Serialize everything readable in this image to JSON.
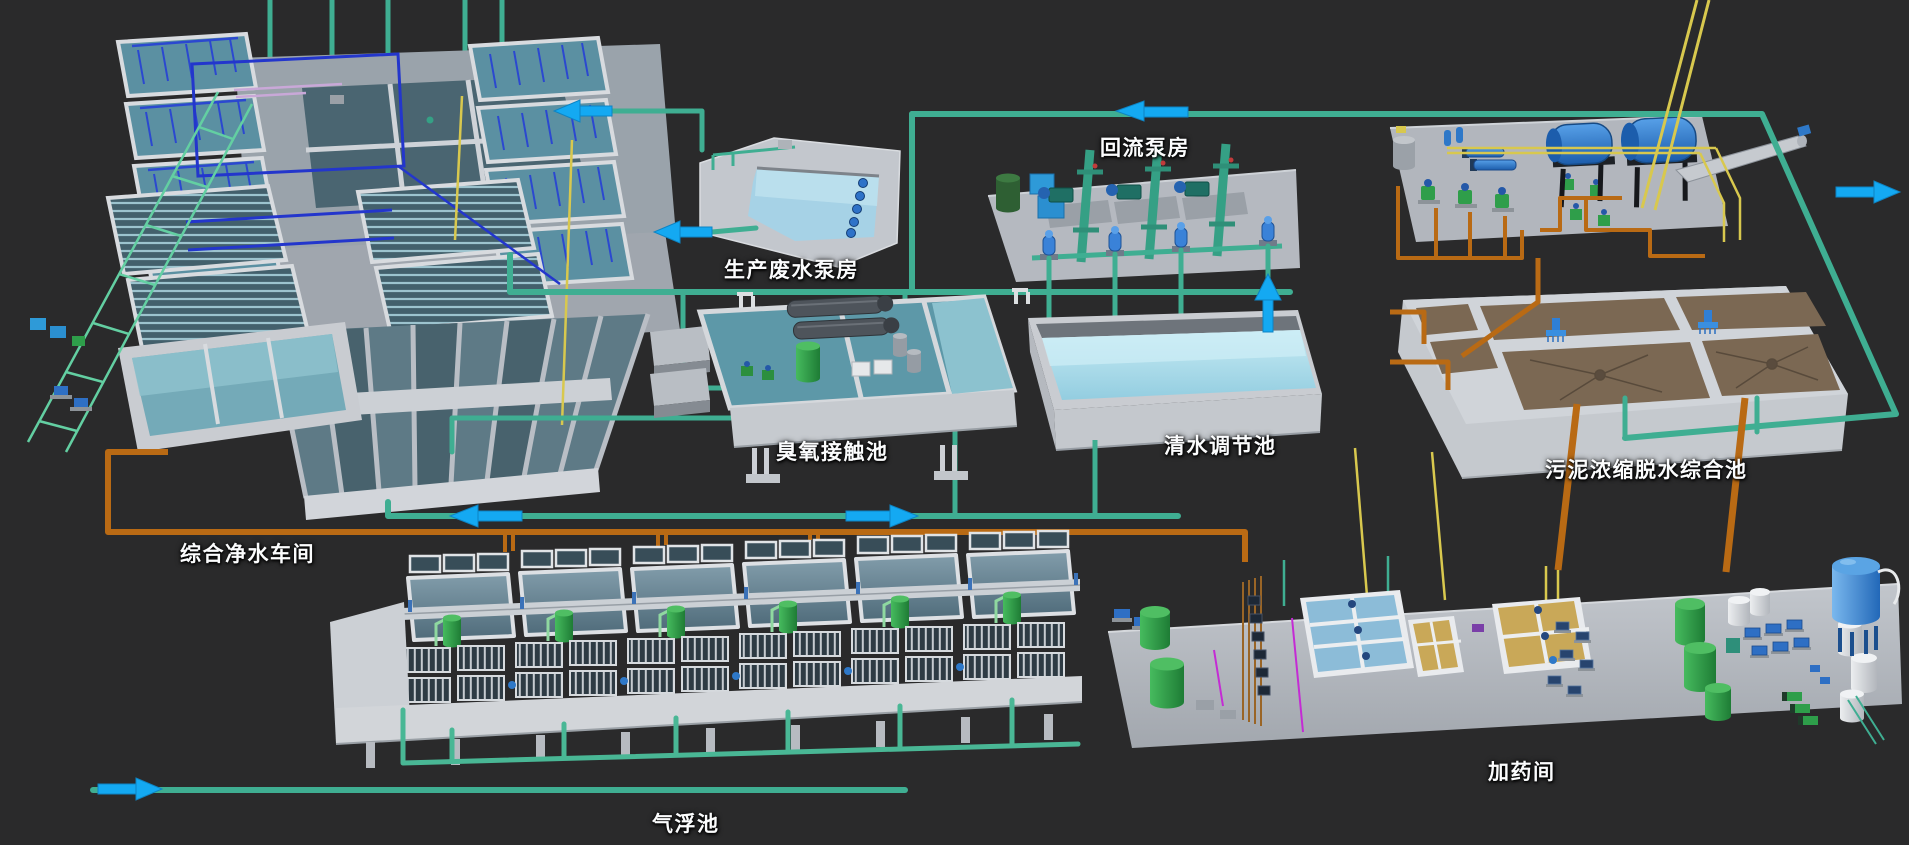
{
  "scene": {
    "description": "3D isometric overview of a wastewater treatment plant",
    "background_color": "#2a2a2b"
  },
  "facilities": [
    {
      "id": "water-purification-workshop",
      "label": "综合净水车间"
    },
    {
      "id": "production-wastewater-pump-house",
      "label": "生产废水泵房"
    },
    {
      "id": "reflux-pump-house",
      "label": "回流泵房"
    },
    {
      "id": "ozone-contact-pool",
      "label": "臭氧接触池"
    },
    {
      "id": "clear-water-regulating-pool",
      "label": "清水调节池"
    },
    {
      "id": "sludge-thickening-dewatering-pool",
      "label": "污泥浓缩脱水综合池"
    },
    {
      "id": "air-flotation-pool",
      "label": "气浮池"
    },
    {
      "id": "dosing-room",
      "label": "加药间"
    }
  ],
  "flow_arrows": [
    {
      "direction": "left",
      "location": "upper outfall left of production wastewater pump house"
    },
    {
      "direction": "left",
      "location": "outlet pipe of production wastewater pump house"
    },
    {
      "direction": "left",
      "location": "top pipeline near reflux pump house"
    },
    {
      "direction": "up",
      "location": "riser from clear water regulating pool to reflux pump house"
    },
    {
      "direction": "left",
      "location": "middle transfer pipeline, west branch"
    },
    {
      "direction": "right",
      "location": "middle transfer pipeline, east branch"
    },
    {
      "direction": "right",
      "location": "east outfall beside sludge dewatering platform"
    },
    {
      "direction": "right",
      "location": "southwest intake pipeline"
    }
  ],
  "palette": {
    "background": "#2a2a2b",
    "concrete_light": "#d0d4d9",
    "concrete": "#b5b9c0",
    "water_clear": "#aadcec",
    "water_process": "#5d98a8",
    "water_cell": "#607c8b",
    "sludge_brown": "#7b6853",
    "pipe_clean_water": "#3fae92",
    "pipe_sludge": "#b96a14",
    "pipe_chemical": "#d8c84e",
    "pipe_process": "#2336cc",
    "flow_arrow": "#14a9f2",
    "tank_green": "#2f9e4a",
    "machine_blue": "#2b7fd8"
  }
}
